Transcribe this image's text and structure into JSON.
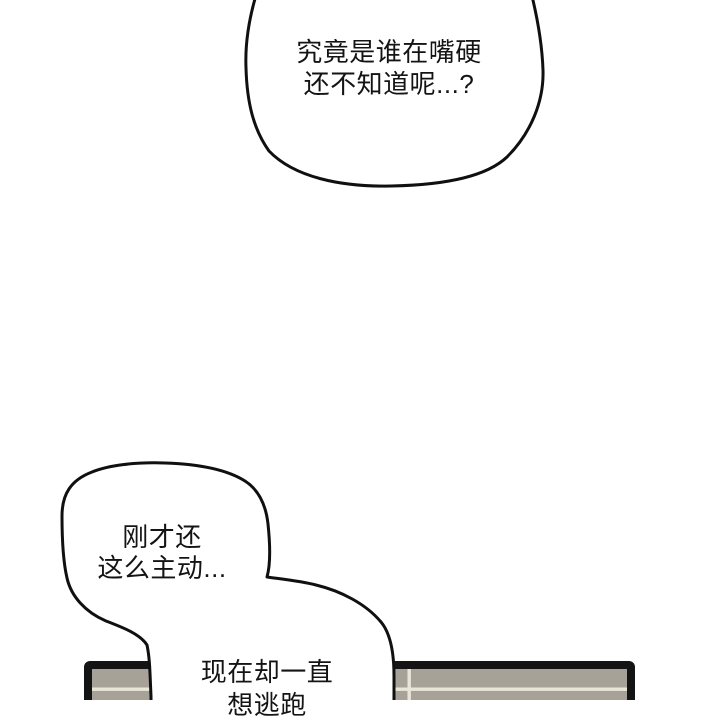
{
  "panel": {
    "background_color": "#ffffff",
    "outline_color": "#101010",
    "text_color": "#141414"
  },
  "bubbles": [
    {
      "name": "top-speech-bubble",
      "lines": [
        "究竟是谁在嘴硬",
        "还不知道呢...?"
      ]
    },
    {
      "name": "middle-speech-bubble",
      "lines": [
        "刚才还",
        "这么主动..."
      ]
    },
    {
      "name": "bottom-speech-bubble",
      "lines": [
        "现在却一直",
        "想逃跑"
      ]
    }
  ],
  "table": {
    "name": "table-surface",
    "edge_color": "#141414",
    "fill_color": "#a6a298",
    "seam_color": "#e9e5d7"
  }
}
